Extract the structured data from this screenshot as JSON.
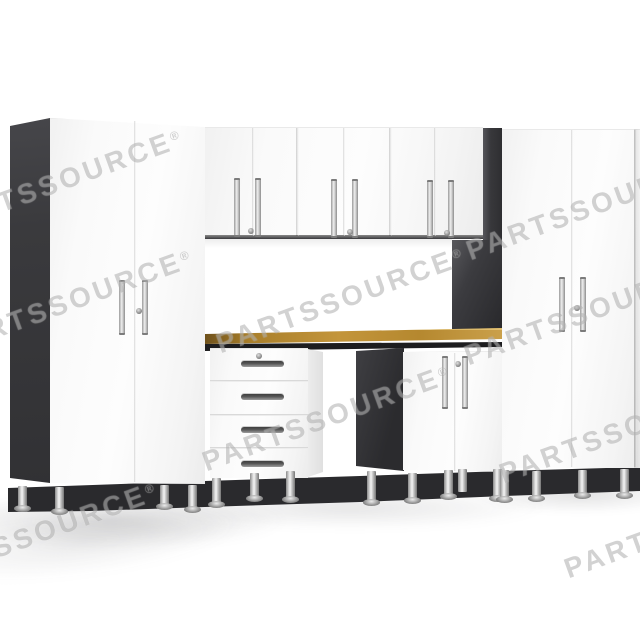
{
  "watermark": {
    "brand": "PARTSSOURCE",
    "symbol": "®",
    "display": "PARTSSOURCE®"
  },
  "colors": {
    "background": "#ffffff",
    "cabinet_white": "#f7f7f7",
    "panel_dark": "#38383c",
    "bench_frame_dark": "#1d1d1f",
    "wood_top": "#a97f2b",
    "wood_top_highlight": "#caa04b",
    "chrome_light": "#f5f5f5",
    "chrome_dark": "#767676",
    "shadow_band": "#2a2a2d",
    "watermark_gray": "#8a8a8a"
  },
  "scene": {
    "subject": "white-garage-cabinet-set-with-wood-workbench",
    "components": [
      "tall-cabinet-left",
      "wall-cabinet-1",
      "wall-cabinet-2",
      "wall-cabinet-3",
      "four-drawer-base-unit",
      "wood-workbench-top",
      "two-door-base-cabinet",
      "tall-cabinet-right"
    ]
  }
}
